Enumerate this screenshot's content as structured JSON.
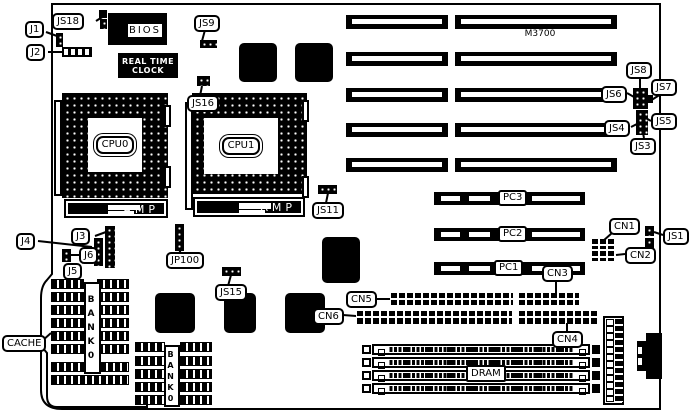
{
  "board": {
    "model": "M3700"
  },
  "chips": {
    "bios": "BIOS",
    "rtc_line1": "REAL TIME",
    "rtc_line2": "CLOCK",
    "cpu0": "CPU0",
    "cpu1": "CPU1",
    "amp_left": "AMP",
    "amp_right": "AMP"
  },
  "slots": {
    "pci": [
      "PC3",
      "PC2",
      "PC1"
    ],
    "dram": "DRAM",
    "bank0_left": "BANK0",
    "bank0_right": "BANK0"
  },
  "labels": {
    "j1": "J1",
    "j2": "J2",
    "j3": "J3",
    "j4": "J4",
    "j5": "J5",
    "j6": "J6",
    "js18": "JS18",
    "js9": "JS9",
    "js16": "JS16",
    "js11": "JS11",
    "js15": "JS15",
    "jp100": "JP100",
    "js8": "JS8",
    "js7": "JS7",
    "js6": "JS6",
    "js5": "JS5",
    "js4": "JS4",
    "js3": "JS3",
    "js1": "JS1",
    "cn1": "CN1",
    "cn2": "CN2",
    "cn3": "CN3",
    "cn4": "CN4",
    "cn5": "CN5",
    "cn6": "CN6",
    "cache": "CACHE"
  }
}
